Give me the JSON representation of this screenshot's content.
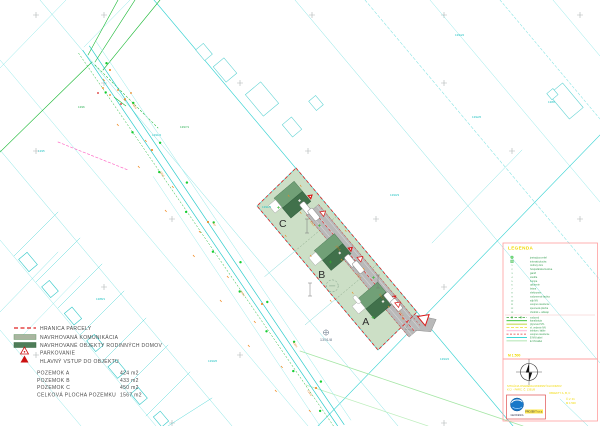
{
  "drawing": {
    "lots": {
      "a": "A",
      "b": "B",
      "c": "C"
    },
    "parcel_number": "1391/8",
    "parcel_labels": [
      "1391/2",
      "1391/5",
      "1390/3",
      "1392/6",
      "1389",
      "1393/2",
      "1388/1",
      "1390/6",
      "1394/2",
      "1395",
      "1396",
      "1397/1"
    ],
    "street_labels": [
      "438/2",
      "215.6",
      "437",
      "216.1",
      "436/1",
      "215.8"
    ],
    "site_labels": [
      "216.3",
      "215.9",
      "216.4",
      "215.7",
      "216.0"
    ]
  },
  "legend": {
    "items": [
      {
        "label": "HRANICA PARCELY"
      },
      {
        "label": "NAVRHOVANÁ KOMUNIKÁCIA"
      },
      {
        "label": "NAVRHOVANÉ OBJEKTY RODINNÝCH DOMOV"
      },
      {
        "label": "PARKOVANIE"
      },
      {
        "label": "HLAVNÝ VSTUP DO OBJEKTU"
      }
    ],
    "table": [
      {
        "name": "POZEMOK A",
        "value": "424 m2"
      },
      {
        "name": "POZEMOK B",
        "value": "433 m2"
      },
      {
        "name": "POZEMOK C",
        "value": "450 m2"
      },
      {
        "name": "CELKOVÁ PLOCHA POZEMKU",
        "value": "1567 m2"
      }
    ]
  },
  "panel": {
    "title": "LEGENDA",
    "items": [
      {
        "num": "",
        "label": "jestvujúca zeleň"
      },
      {
        "num": "",
        "label": "trávnatá plocha"
      },
      {
        "num": "1",
        "label": "rodinný dom"
      },
      {
        "num": "2",
        "label": "hospodárska budova"
      },
      {
        "num": "3",
        "label": "garáž"
      },
      {
        "num": "4",
        "label": "studňa"
      },
      {
        "num": "5",
        "label": "žumpa"
      },
      {
        "num": "6",
        "label": "oplotenie"
      },
      {
        "num": "7",
        "label": "brána"
      },
      {
        "num": "8",
        "label": "elektromer"
      },
      {
        "num": "9",
        "label": "vodomerná šachta"
      },
      {
        "num": "10",
        "label": "stĺp NN"
      },
      {
        "num": "11",
        "label": "verejné osvetlenie"
      },
      {
        "num": "12",
        "label": "spevnená plocha"
      },
      {
        "num": "13",
        "label": "chodník + odkvap"
      }
    ],
    "utility_lines": [
      {
        "label": "vodovod",
        "color": "#3aa63a"
      },
      {
        "label": "kanalizácia",
        "color": "#00b400"
      },
      {
        "label": "plynovod STL",
        "color": "#a8c800"
      },
      {
        "label": "el. vedenie NN",
        "color": "#e8d800"
      },
      {
        "label": "telekom. káble",
        "color": "#ff8fc0"
      },
      {
        "label": "verejné osvetlenie",
        "color": "#e23b3b"
      },
      {
        "label": "E-NN kábel",
        "color": "#00c8c8"
      },
      {
        "label": "E-VN kábel",
        "color": "#98dc98"
      }
    ],
    "scale": "M 1:500",
    "info_lines": [
      "SITUÁCIA OSADENIA RODINNÝCH DOMOV",
      "K.Ú. - PARC. Č. 1391/8",
      "OBJEKTY A, B, C"
    ],
    "side_lines": [
      "Č.V. 01",
      "M 1:500"
    ],
    "stamp": {
      "line1": "GEODESIA",
      "line2": "PROJEKT s.r.o."
    }
  },
  "colors": {
    "cadastral_cyan": "#35d2d2",
    "site_fill": "#ccdfc6",
    "building_dark": "#41714b",
    "building_light": "#71a077",
    "road_gray": "#b9b9b9",
    "boundary_red": "#e02020",
    "panel_pink": "#ff9e9e",
    "highlight_yellow": "#f0d800"
  }
}
